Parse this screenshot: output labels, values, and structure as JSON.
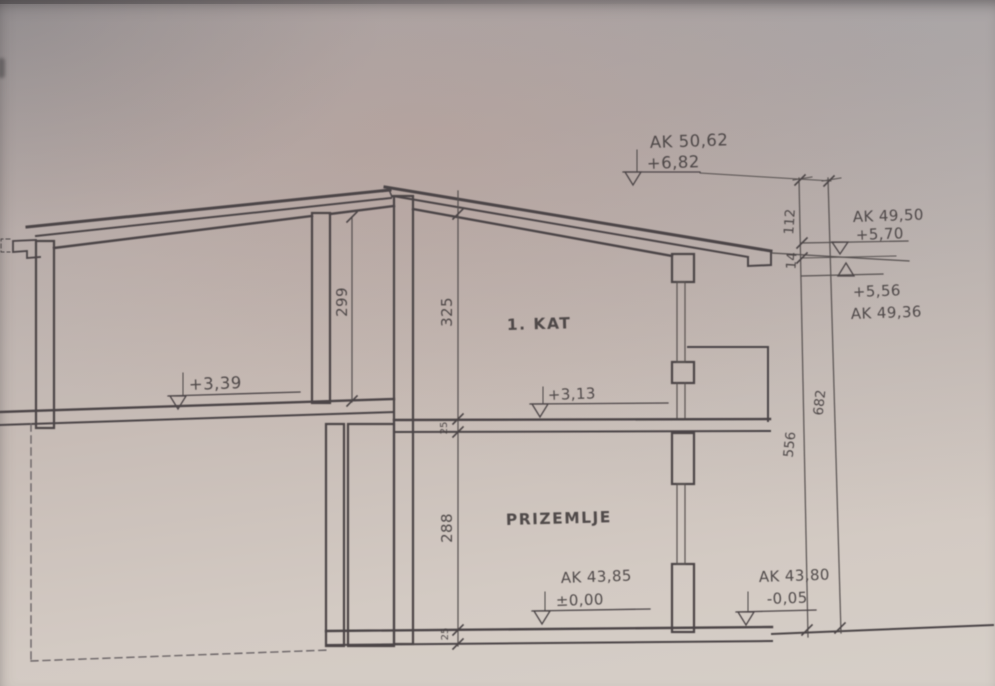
{
  "drawing": {
    "kind": "building cross-section (photographed architectural drawing)",
    "rooms": {
      "first_floor_label": "1. KAT",
      "ground_floor_label": "PRIZEMLJE"
    },
    "levels": {
      "ridge_ak": "AK 50,62",
      "ridge_rel": "+6,82",
      "eave_top_ak": "AK 49,50",
      "eave_top_rel": "+5,70",
      "eave_bottom_rel": "+5,56",
      "eave_bottom_ak": "AK 49,36",
      "first_floor_left_rel": "+3,39",
      "first_floor_right_rel": "+3,13",
      "ground_floor_ak": "AK 43,85",
      "ground_floor_rel": "±0,00",
      "terrain_ak": "AK 43,80",
      "terrain_rel": "-0,05"
    },
    "dimensions": {
      "ridge_to_eave": "112",
      "eave_thickness": "14",
      "left_room_height": "299",
      "first_floor_height": "325",
      "ground_floor_height": "288",
      "eave_to_ground": "556",
      "total_height": "682",
      "middle_slab": "25",
      "bottom_slab": "25"
    }
  }
}
